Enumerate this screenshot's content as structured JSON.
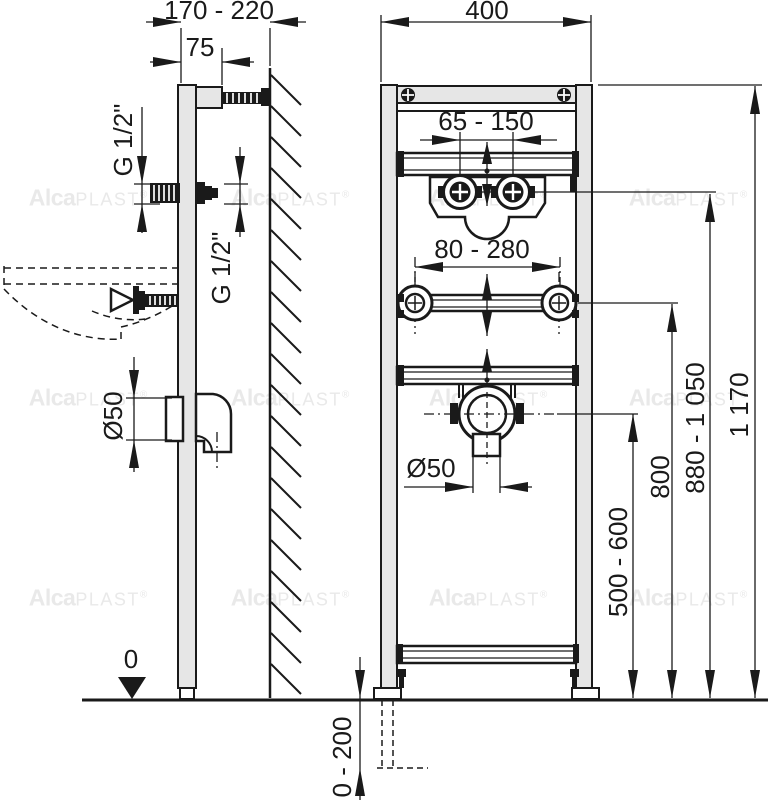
{
  "side_view": {
    "frame_depth": "170 - 220",
    "front_offset": "75",
    "thread_front": "G 1/2\"",
    "thread_rear": "G 1/2\"",
    "drain_diameter": "Ø50",
    "floor_zero": "0"
  },
  "front_view": {
    "frame_width": "400",
    "tap_spacing": "65 - 150",
    "bolt_spacing": "80 - 280",
    "drain_diameter": "Ø50",
    "height_drain": "500 - 600",
    "height_bolts": "800",
    "height_taps": "880 - 1 050",
    "height_frame": "1 170",
    "floor_adjust": "0 - 200"
  },
  "watermark": {
    "bold": "Alca",
    "light": "PLAST",
    "reg": "®"
  },
  "colors": {
    "line": "#1a1a1a",
    "frame_fill": "#e6e6e6",
    "watermark": "#e9e9e9",
    "background": "#ffffff"
  }
}
